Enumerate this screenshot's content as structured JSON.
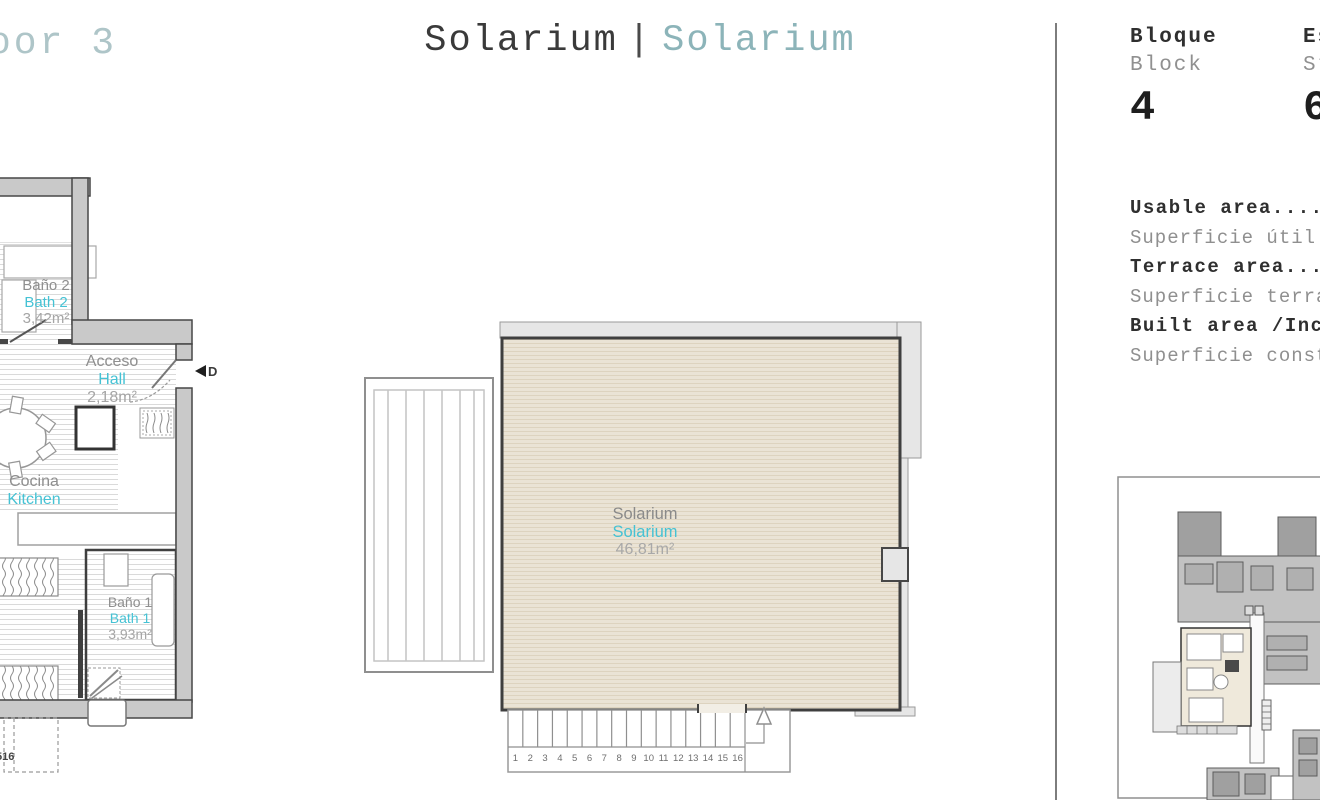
{
  "page": {
    "floor_label_partial": "oor 3",
    "title": {
      "es": "Solarium",
      "divider": "|",
      "en": "Solarium"
    }
  },
  "info_panel": {
    "block": {
      "label_es": "Bloque",
      "label_en": "Block",
      "value": "4"
    },
    "stair": {
      "label_es": "Escalera",
      "label_en": "Stairs",
      "value": "6"
    },
    "areas": [
      {
        "text": "Usable area...........",
        "style": "bold"
      },
      {
        "text": "Superficie útil.......",
        "style": "light"
      },
      {
        "text": "Terrace area..........",
        "style": "bold"
      },
      {
        "text": "Superficie terraza....",
        "style": "light"
      },
      {
        "text": "Built area /Includ....",
        "style": "bold"
      },
      {
        "text": "Superficie construida.",
        "style": "light"
      }
    ]
  },
  "apartment_plan": {
    "rooms": {
      "bath2": {
        "name_es": "Baño 2",
        "name_en": "Bath 2",
        "area": "3,42m²"
      },
      "hall": {
        "name_es": "Acceso",
        "name_en": "Hall",
        "area": "2,18m²"
      },
      "kitchen": {
        "name_es": "Cocina",
        "name_en": "Kitchen"
      },
      "bath1": {
        "name_es": "Baño 1",
        "name_en": "Bath 1",
        "area": "3,93m²"
      }
    },
    "door_marker": "D",
    "stair_label_partial": "516"
  },
  "solarium_plan": {
    "room": {
      "name_es": "Solarium",
      "name_en": "Solarium",
      "area": "46,81m²"
    },
    "stair_numbers": [
      "1",
      "2",
      "3",
      "4",
      "5",
      "6",
      "7",
      "8",
      "9",
      "10",
      "11",
      "12",
      "13",
      "14",
      "15",
      "16"
    ]
  },
  "colors": {
    "accent_cyan": "#45c2d4",
    "title_teal": "#8cb4b9",
    "text_dark": "#3a3a3a",
    "text_gray": "#8f8f8f",
    "solarium_beige": "#eae3d5",
    "wall_gray": "#c9c9c9"
  }
}
